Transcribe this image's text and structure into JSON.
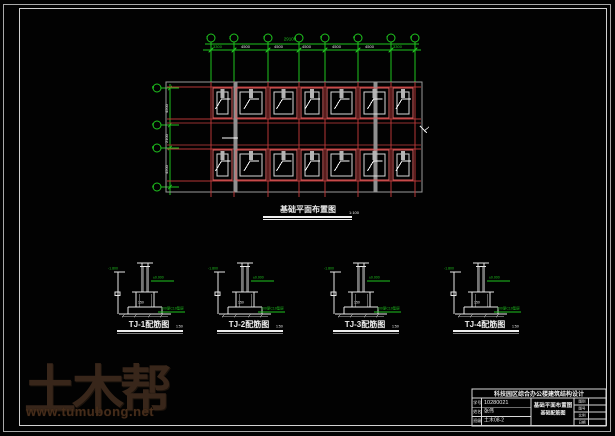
{
  "plan": {
    "title": "基础平面布置图",
    "scale": "1:100",
    "total_dim": "29100",
    "top_dims": [
      "3300",
      "4500",
      "4500",
      "4500",
      "4500",
      "4500",
      "3300"
    ],
    "left_dims": [
      "4500",
      "2100",
      "4500"
    ],
    "axes_top": [
      "1",
      "2",
      "3",
      "4",
      "5",
      "6",
      "7",
      "8"
    ],
    "axes_left": [
      "D",
      "C",
      "B",
      "A"
    ]
  },
  "details": [
    {
      "label": "TJ-1配筋图",
      "scale": "1:50",
      "dim_left": "-1.800",
      "note_top": "±0.000",
      "note_bottom": "100厚C10垫层",
      "dim_bottom": "150"
    },
    {
      "label": "TJ-2配筋图",
      "scale": "1:50",
      "dim_left": "-1.800",
      "note_top": "±0.000",
      "note_bottom": "100厚C10垫层",
      "dim_bottom": "150"
    },
    {
      "label": "TJ-3配筋图",
      "scale": "1:50",
      "dim_left": "-1.800",
      "note_top": "±0.000",
      "note_bottom": "100厚C10垫层",
      "dim_bottom": "150"
    },
    {
      "label": "TJ-4配筋图",
      "scale": "1:50",
      "dim_left": "-1.800",
      "note_top": "±0.000",
      "note_bottom": "100厚C10垫层",
      "dim_bottom": "150"
    }
  ],
  "title_block": {
    "header": "科技园区综合办公楼建筑结构设计",
    "rows": [
      {
        "label": "学号",
        "value": "10280021"
      },
      {
        "label": "姓名",
        "value": "张伟"
      },
      {
        "label": "班级",
        "value": "土木08-2"
      }
    ],
    "center_line1": "基础平面布置图",
    "center_line2": "基础配筋图",
    "right_rows": [
      {
        "label": "图别"
      },
      {
        "label": "图号"
      },
      {
        "label": "比例"
      },
      {
        "label": "日期"
      }
    ]
  },
  "watermark": {
    "brand": "土木帮",
    "url": "www.tumubong.net"
  },
  "colors": {
    "cad_green": "#1fc41f",
    "cad_red": "#b53636",
    "footing_red": "#d96060",
    "watermark_brown": "#38261a"
  }
}
